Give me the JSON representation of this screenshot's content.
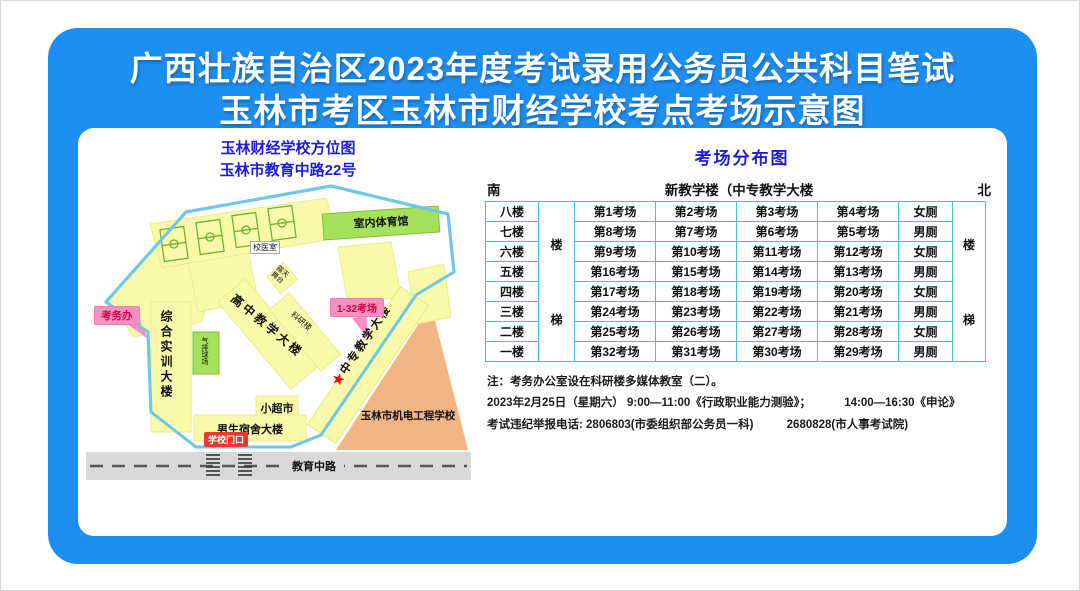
{
  "title": {
    "line1": "广西壮族自治区2023年度考试录用公务员公共科目笔试",
    "line2": "玉林市考区玉林市财经学校考点考场示意图"
  },
  "map": {
    "header_line1": "玉林财经学校方位图",
    "header_line2": "玉林市教育中路22号",
    "labels": {
      "gym": "室内体育馆",
      "clinic": "校医室",
      "stage": "露天舞台",
      "research": "科研楼",
      "highschool_building": "高中教学大楼",
      "zhongzhuan_building": "中专教学大楼",
      "star": "★",
      "training_building": "综合实训大楼",
      "volleyball_court": "气排球场",
      "supermarket": "小超市",
      "dorm": "男生宿舍大楼",
      "neighbor_school": "玉林市机电工程学校",
      "road": "教育中路",
      "exam_office": "考务办",
      "exam_rooms": "1-32考场",
      "gate": "学校门口"
    }
  },
  "table": {
    "title": "考场分布图",
    "direction_south": "南",
    "direction_north": "北",
    "building_header": "新教学楼（中专教学大楼",
    "stair_top": "楼",
    "stair_bottom": "梯",
    "rows": [
      {
        "floor": "八楼",
        "c1": "第1考场",
        "c2": "第2考场",
        "c3": "第3考场",
        "c4": "第4考场",
        "wc": "女厕"
      },
      {
        "floor": "七楼",
        "c1": "第8考场",
        "c2": "第7考场",
        "c3": "第6考场",
        "c4": "第5考场",
        "wc": "男厕"
      },
      {
        "floor": "六楼",
        "c1": "第9考场",
        "c2": "第10考场",
        "c3": "第11考场",
        "c4": "第12考场",
        "wc": "女厕"
      },
      {
        "floor": "五楼",
        "c1": "第16考场",
        "c2": "第15考场",
        "c3": "第14考场",
        "c4": "第13考场",
        "wc": "男厕"
      },
      {
        "floor": "四楼",
        "c1": "第17考场",
        "c2": "第18考场",
        "c3": "第19考场",
        "c4": "第20考场",
        "wc": "女厕"
      },
      {
        "floor": "三楼",
        "c1": "第24考场",
        "c2": "第23考场",
        "c3": "第22考场",
        "c4": "第21考场",
        "wc": "男厕"
      },
      {
        "floor": "二楼",
        "c1": "第25考场",
        "c2": "第26考场",
        "c3": "第27考场",
        "c4": "第28考场",
        "wc": "女厕"
      },
      {
        "floor": "一楼",
        "c1": "第32考场",
        "c2": "第31考场",
        "c3": "第30考场",
        "c4": "第29考场",
        "wc": "男厕"
      }
    ]
  },
  "notes": {
    "line1": "注：考务办公室设在科研楼多媒体教室（二）。",
    "line2a": "2023年2月25日（星期六） 9:00—11:00《行政职业能力测验》；",
    "line2b": "14:00—16:30《申论》",
    "line3a": "考试违纪举报电话: 2806803(市委组织部公务员一科)",
    "line3b": "2680828(市人事考试院)"
  },
  "colors": {
    "card_blue": "#1d8ff2",
    "heading_blue": "#1c1cd8",
    "table_border_teal": "#45c0cd",
    "callout_pink": "#f590c5",
    "callout_text_red": "#d5003c",
    "gate_red": "#e8392f",
    "building_yellow": "#f9f9a9",
    "sport_green": "#a6e15e",
    "neighbor_orange": "#f2b482",
    "road_gray": "#d9d9d9",
    "boundary_blue": "#6cc7ea"
  }
}
